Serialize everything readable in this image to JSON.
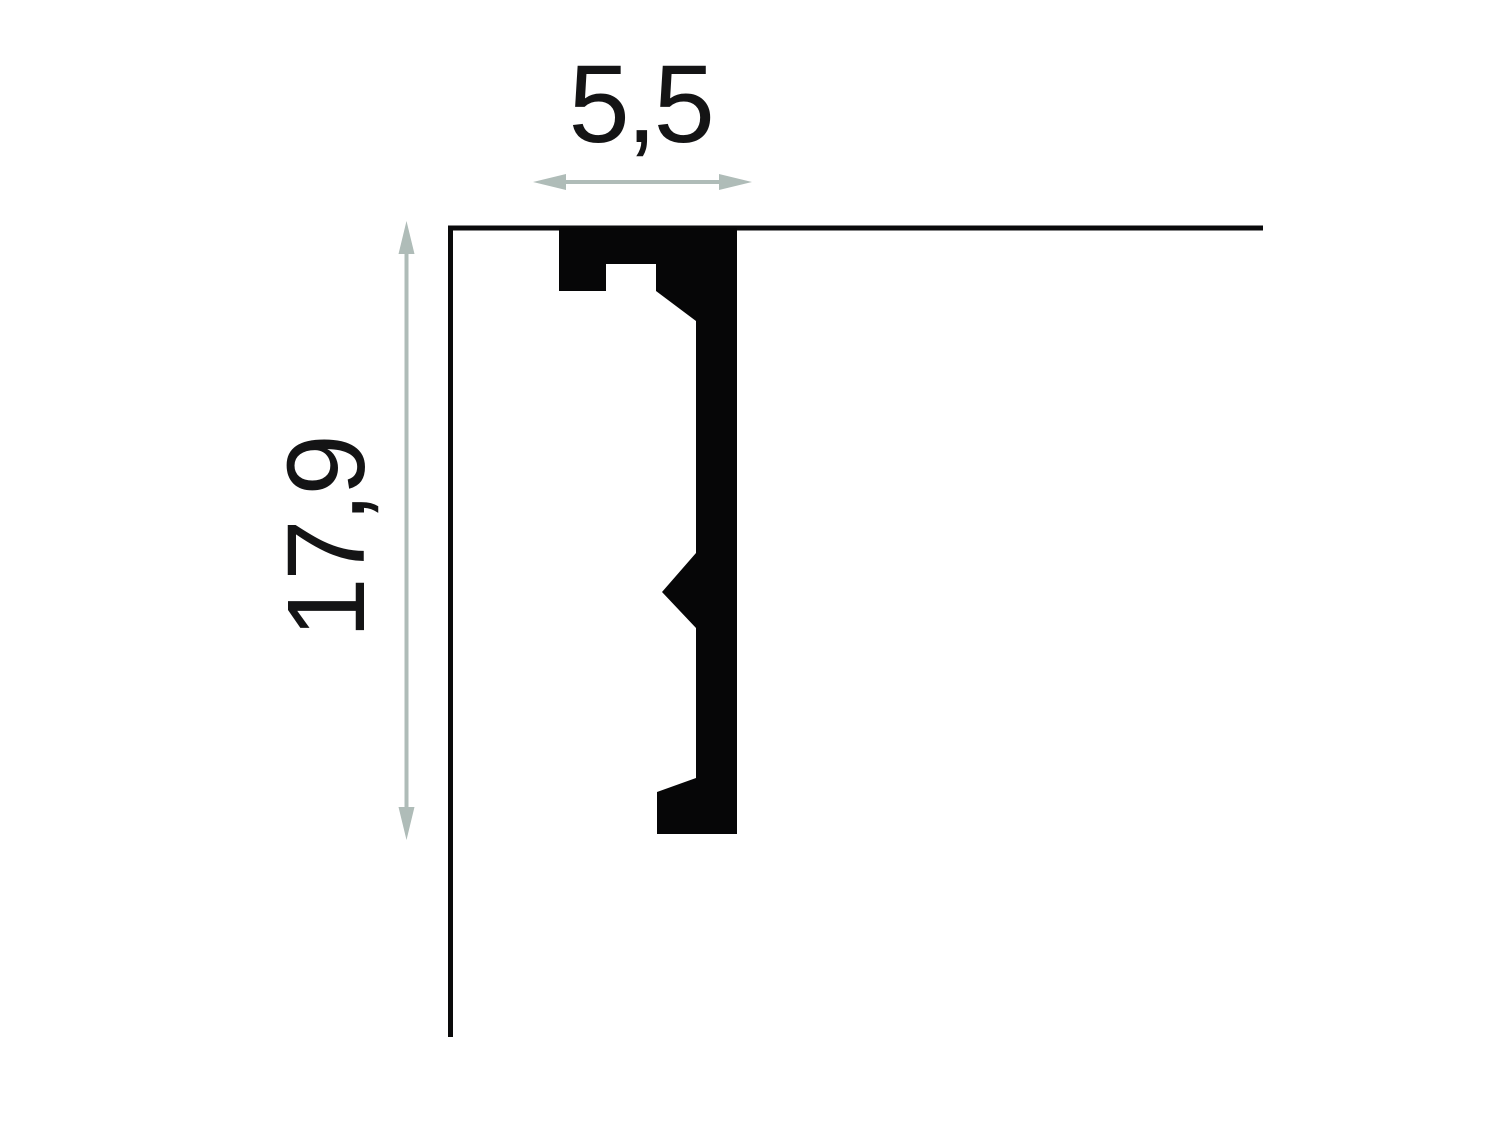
{
  "diagram": {
    "type": "molding-profile-cross-section",
    "width_label": "5,5",
    "height_label": "17,9",
    "profile_points": "559,228 737,228 737,834 657,834 657,792 696,778 696,628 662,592 696,553 696,321 656,291 656,264 606,264 606,291 559,291",
    "ceiling_line": {
      "x1": 448,
      "y1": 228,
      "x2": 1263,
      "y2": 228
    },
    "wall_line": {
      "x1": 450.5,
      "y1": 226,
      "x2": 450.5,
      "y2": 1037
    },
    "width_arrow": {
      "left_tip_x": 533,
      "right_tip_x": 752,
      "y": 182
    },
    "height_arrow": {
      "top_tip_y": 221,
      "bottom_tip_y": 840,
      "x": 406.5
    },
    "colors": {
      "background": "#ffffff",
      "line": "#0a0a0b",
      "profile_fill": "#060607",
      "arrow": "#afbcb8",
      "text": "#141415"
    }
  }
}
